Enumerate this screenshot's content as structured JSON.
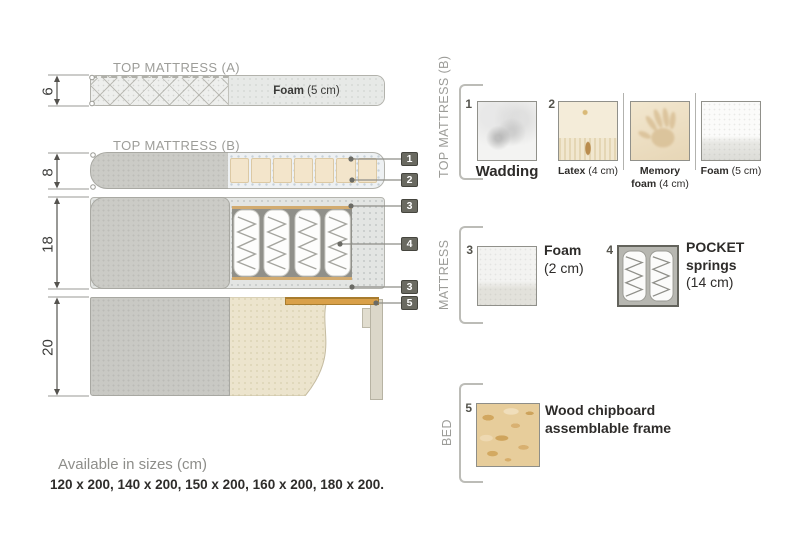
{
  "diagram": {
    "title_a": "TOP MATTRESS (A)",
    "title_b": "TOP MATTRESS (B)",
    "dims": [
      "6",
      "8",
      "18",
      "20"
    ],
    "foam_a": {
      "name": "Foam",
      "size": "(5 cm)"
    },
    "callouts": [
      "1",
      "2",
      "3",
      "4",
      "3",
      "5"
    ]
  },
  "legend": {
    "top_b": {
      "section_title": "TOP MATTRESS (B)",
      "items": [
        {
          "num": "1",
          "name": "Wadding",
          "size": ""
        },
        {
          "num": "2",
          "name": "Latex",
          "size": "(4 cm)"
        },
        {
          "num": "",
          "name": "Memory foam",
          "size": "(4 cm)"
        },
        {
          "num": "",
          "name": "Foam",
          "size": "(5 cm)"
        }
      ]
    },
    "mattress": {
      "section_title": "MATTRESS",
      "items": [
        {
          "num": "3",
          "name": "Foam",
          "size": "(2 cm)"
        },
        {
          "num": "4",
          "name": "POCKET springs",
          "size": "(14 cm)"
        }
      ]
    },
    "bed": {
      "section_title": "BED",
      "items": [
        {
          "num": "5",
          "name": "Wood chipboard assemblable frame",
          "size": ""
        }
      ]
    }
  },
  "footer": {
    "title": "Available in sizes (cm)",
    "sizes": "120 x 200, 140 x 200, 150 x 200, 160 x 200, 180 x 200."
  },
  "colors": {
    "wood_slat": "#d9a049",
    "fabric_gray": "#cbcbc6",
    "latex_beige": "#f3e5cb",
    "callout_chip": "#6a6a61",
    "wadding_tint": "#eef1f3",
    "title_gray": "#9d9d99"
  }
}
